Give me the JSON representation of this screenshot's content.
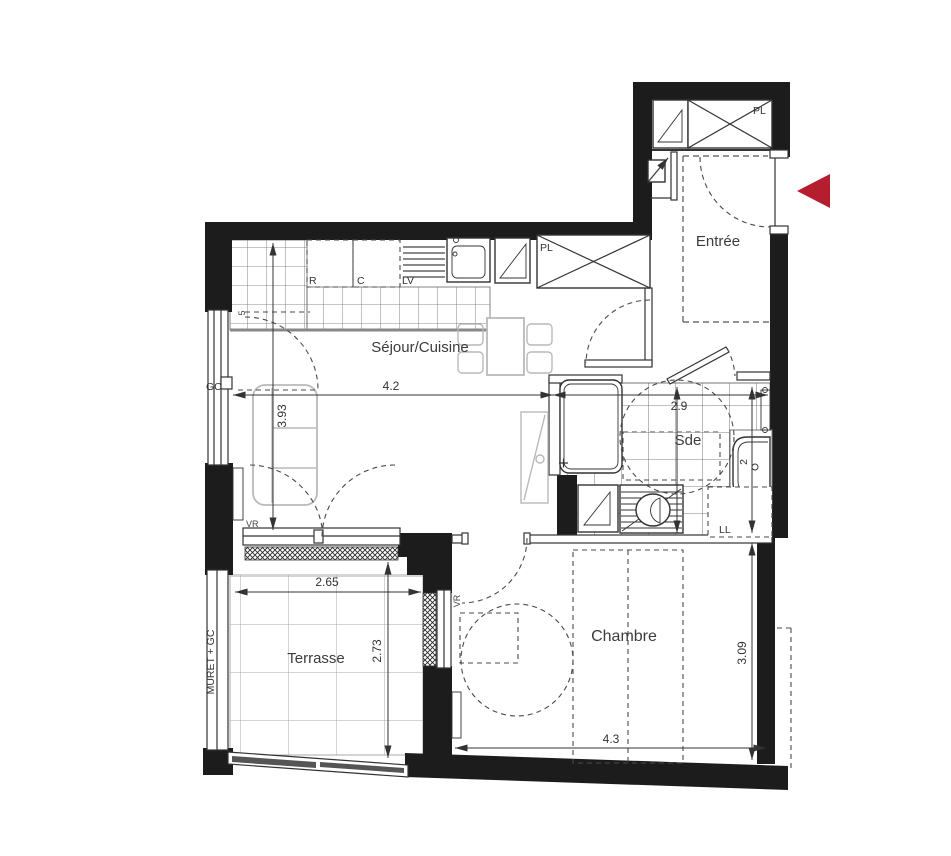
{
  "colors": {
    "wall": "#1c1c1c",
    "line": "#333333",
    "furniture": "#b9b9b9",
    "entry_arrow": "#b51e2e",
    "dashed": "#4a4a4a"
  },
  "rooms": {
    "entree": "Entrée",
    "sejour": "Séjour/Cuisine",
    "sde": "Sde",
    "chambre": "Chambre",
    "terrasse": "Terrasse"
  },
  "dimensions": {
    "sejour_width": "4.2",
    "sde_width": "2.9",
    "sejour_height": "3.93",
    "terrasse_width": "2.65",
    "terrasse_height": "2.73",
    "chambre_height": "3.09",
    "chambre_width": "4.3"
  },
  "annotations": {
    "closet_entry": "PL",
    "closet_sejour": "PL",
    "fridge": "R",
    "cooktop": "C",
    "dishwasher": "LV",
    "guardrail": "GC",
    "shutter_sejour": "VR",
    "shutter_chambre": "VR",
    "washing_machine": "LL",
    "terrace_wall": "MURET + GC",
    "window_code": "5",
    "basin_code": "2"
  }
}
